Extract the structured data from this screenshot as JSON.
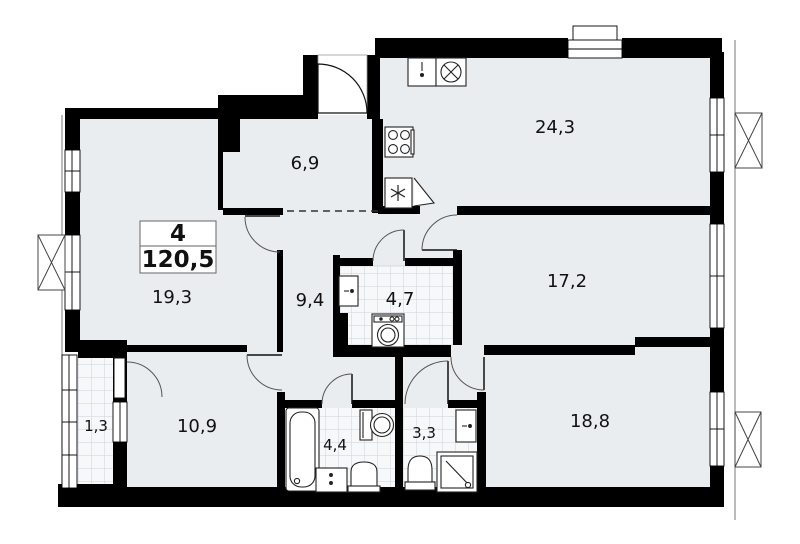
{
  "plan": {
    "info_box": {
      "rooms_count": "4",
      "total_area": "120,5"
    },
    "room_labels": {
      "living_kitchen": "24,3",
      "entry_hall": "6,9",
      "bedroom_a": "17,2",
      "bedroom_b": "19,3",
      "corridor": "9,4",
      "bathroom_main": "4,7",
      "bedroom_c": "18,8",
      "inner_hall": "10,9",
      "bath": "4,4",
      "shower_wc": "3,3",
      "loggia": "1,3"
    },
    "colors": {
      "wall": "#000000",
      "floor": "#e9edf0",
      "tile_background": "#f6f8fa",
      "tile_grid": "#ccd2d9",
      "fixture_outline": "#222222",
      "door_arc": "#555555"
    }
  }
}
